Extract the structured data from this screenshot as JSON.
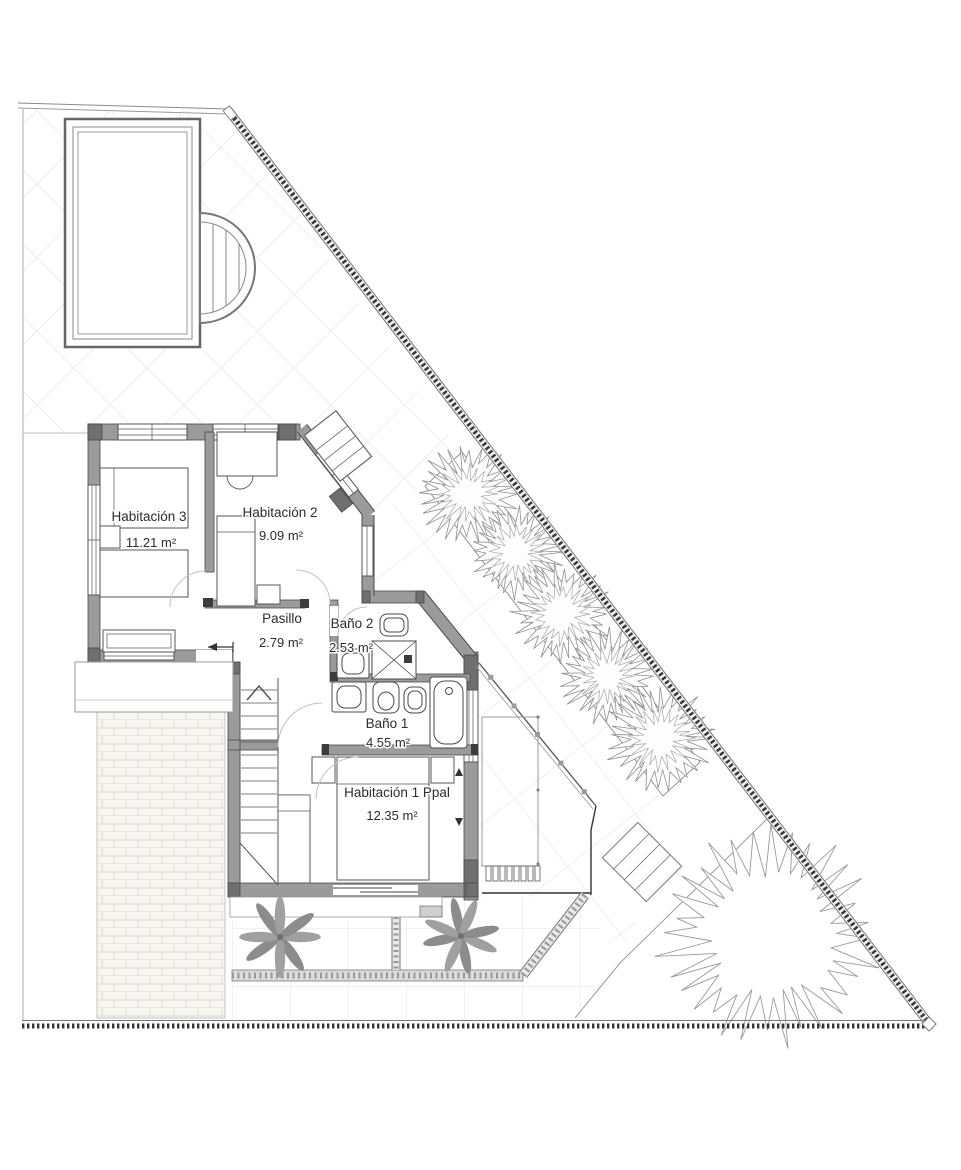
{
  "document": {
    "type": "architectural-floor-plan",
    "language": "es",
    "area_unit": "m²"
  },
  "rooms": [
    {
      "id": "habitacion-3",
      "name": "Habitación 3",
      "area": "11.21 m²"
    },
    {
      "id": "habitacion-2",
      "name": "Habitación 2",
      "area": "9.09 m²"
    },
    {
      "id": "pasillo",
      "name": "Pasillo",
      "area": "2.79 m²"
    },
    {
      "id": "bano-2",
      "name": "Baño 2",
      "area": "2.53 m²"
    },
    {
      "id": "bano-1",
      "name": "Baño 1",
      "area": "4.55 m²"
    },
    {
      "id": "habitacion-1-ppal",
      "name": "Habitación 1 Ppal",
      "area": "12.35 m²"
    }
  ],
  "site_features": [
    "swimming-pool",
    "tiled-pool-deck",
    "hedge-row",
    "garden-lawn",
    "large-tree",
    "palm-planters",
    "terrace",
    "exterior-steps",
    "brick-driveway",
    "perimeter-fence",
    "staircase"
  ],
  "colors": {
    "wall_fill": "#9b9b9b",
    "wall_dark": "#6f6f6f",
    "outline": "#4a4a4a",
    "fence_tick": "#3a3333",
    "grid_line": "#dedede",
    "text": "#2d2d2d",
    "background": "#ffffff"
  }
}
